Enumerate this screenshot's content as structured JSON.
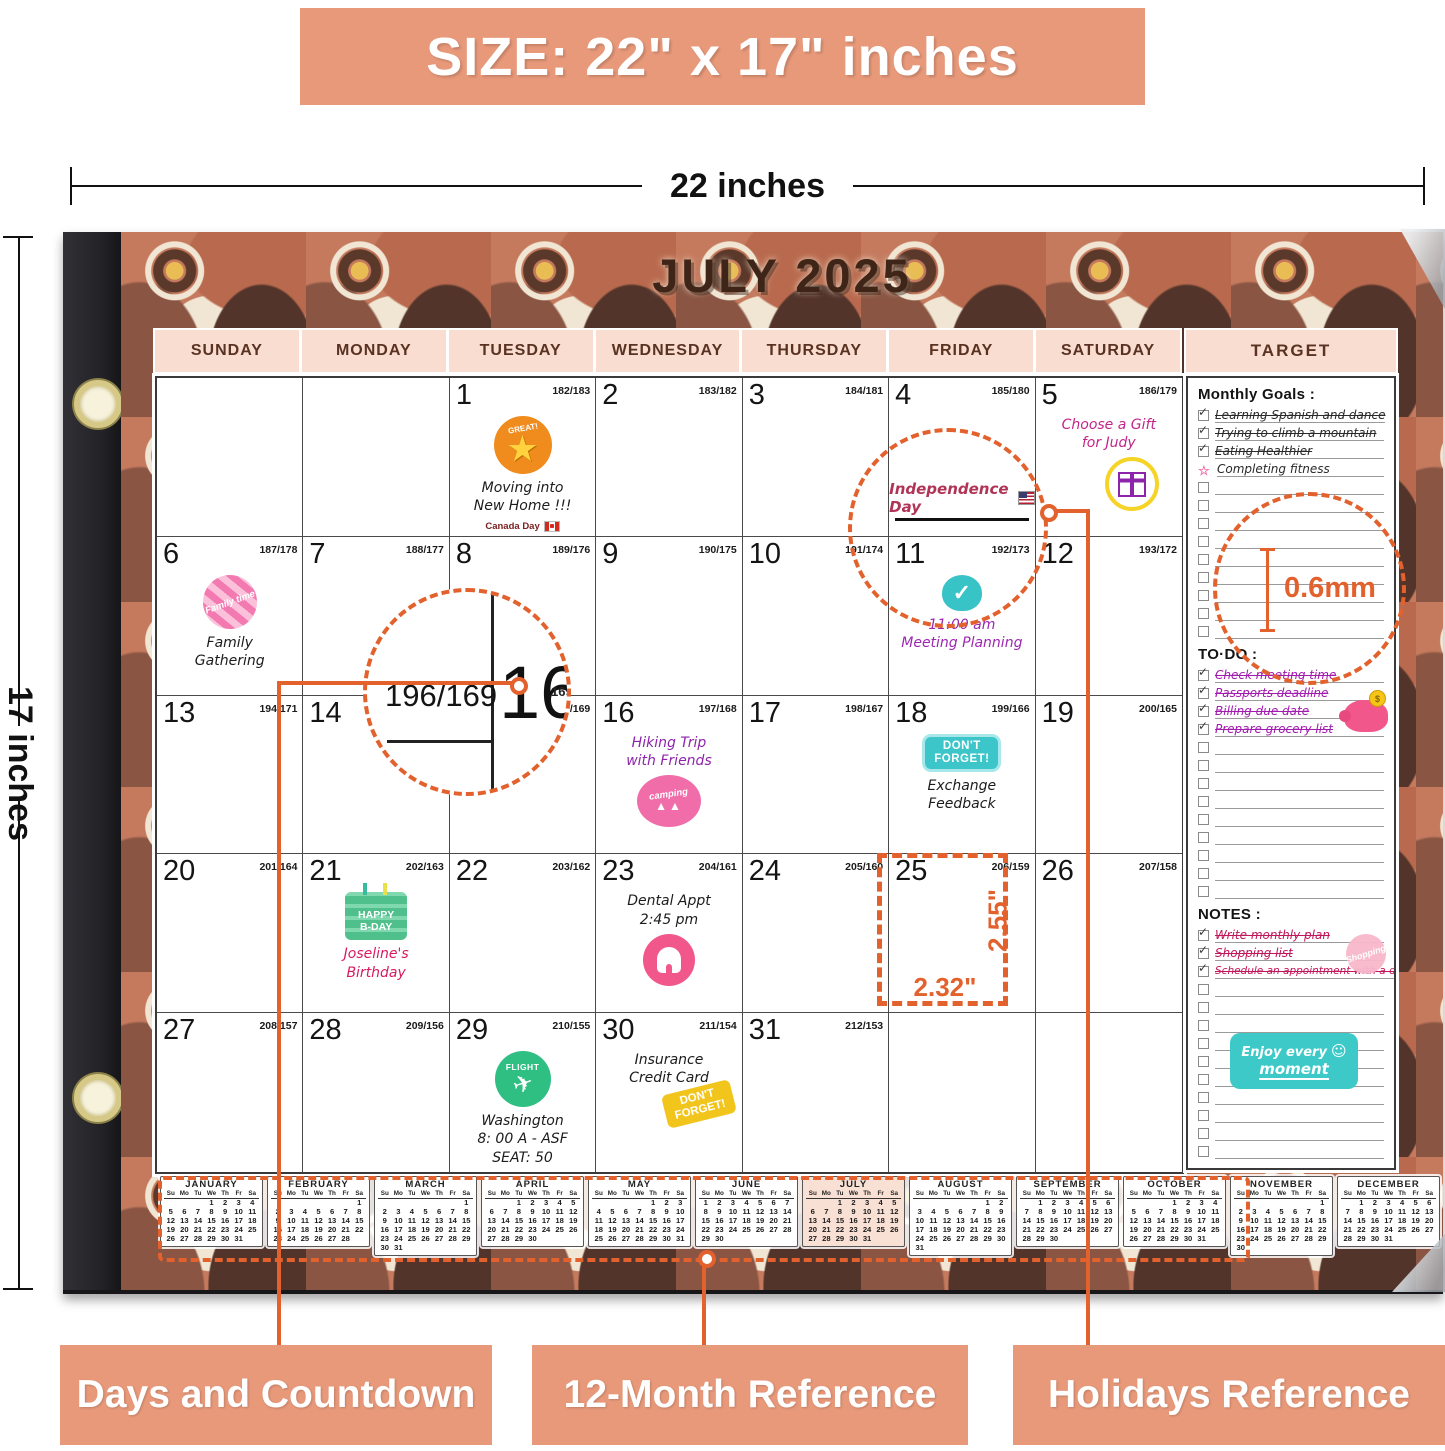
{
  "banner": {
    "text": "SIZE: 22\" x 17\" inches"
  },
  "measure": {
    "width": "22 inches",
    "height": "17 inches"
  },
  "calendar": {
    "title": "JULY 2025",
    "day_headers": [
      "SUNDAY",
      "MONDAY",
      "TUESDAY",
      "WEDNESDAY",
      "THURSDAY",
      "FRIDAY",
      "SATURDAY"
    ],
    "weeks": [
      [
        {
          "date": "",
          "countdown": ""
        },
        {
          "date": "",
          "countdown": ""
        },
        {
          "date": "1",
          "countdown": "182/183",
          "sticker": "great-star",
          "sticker_pos": "above",
          "events": [
            {
              "lines": [
                "Moving into",
                "New Home !!!"
              ],
              "color": "#1c1c1c"
            }
          ],
          "footer": "Canada Day"
        },
        {
          "date": "2",
          "countdown": "183/182"
        },
        {
          "date": "3",
          "countdown": "184/181"
        },
        {
          "date": "4",
          "countdown": "185/180",
          "holiday": "Independence Day"
        },
        {
          "date": "5",
          "countdown": "186/179",
          "sticker": "gift",
          "sticker_pos": "below",
          "events": [
            {
              "lines": [
                "Choose a Gift",
                "for Judy"
              ],
              "color": "#c2258a"
            }
          ]
        }
      ],
      [
        {
          "date": "6",
          "countdown": "187/178",
          "sticker": "family-time",
          "sticker_pos": "above",
          "events": [
            {
              "lines": [
                "Family",
                "Gathering"
              ],
              "color": "#1c1c1c"
            }
          ]
        },
        {
          "date": "7",
          "countdown": "188/177"
        },
        {
          "date": "8",
          "countdown": "189/176"
        },
        {
          "date": "9",
          "countdown": "190/175"
        },
        {
          "date": "10",
          "countdown": "191/174"
        },
        {
          "date": "11",
          "countdown": "192/173",
          "sticker": "check",
          "sticker_pos": "above",
          "events": [
            {
              "lines": [
                "11:00 am",
                "Meeting Planning"
              ],
              "color": "#9c27b0"
            }
          ]
        },
        {
          "date": "12",
          "countdown": "193/172"
        }
      ],
      [
        {
          "date": "13",
          "countdown": "194/171"
        },
        {
          "date": "14",
          "countdown": "195/170"
        },
        {
          "date": "15",
          "countdown": "196/169"
        },
        {
          "date": "16",
          "countdown": "197/168",
          "sticker": "camping",
          "sticker_pos": "below",
          "events": [
            {
              "lines": [
                "Hiking Trip",
                "with Friends"
              ],
              "color": "#8e24aa"
            }
          ]
        },
        {
          "date": "17",
          "countdown": "198/167"
        },
        {
          "date": "18",
          "countdown": "199/166",
          "sticker": "dont-forget-teal",
          "sticker_pos": "above",
          "events": [
            {
              "lines": [
                "Exchange",
                "Feedback"
              ],
              "color": "#1c1c1c"
            }
          ]
        },
        {
          "date": "19",
          "countdown": "200/165"
        }
      ],
      [
        {
          "date": "20",
          "countdown": "201/164"
        },
        {
          "date": "21",
          "countdown": "202/163",
          "sticker": "birthday-cake",
          "sticker_pos": "above",
          "events": [
            {
              "lines": [
                "Joseline's",
                "Birthday"
              ],
              "color": "#d81b60"
            }
          ]
        },
        {
          "date": "22",
          "countdown": "203/162"
        },
        {
          "date": "23",
          "countdown": "204/161",
          "sticker": "tooth",
          "sticker_pos": "below",
          "events": [
            {
              "lines": [
                "Dental Appt",
                "2:45 pm"
              ],
              "color": "#1c1c1c"
            }
          ]
        },
        {
          "date": "24",
          "countdown": "205/160"
        },
        {
          "date": "25",
          "countdown": "206/159"
        },
        {
          "date": "26",
          "countdown": "207/158"
        }
      ],
      [
        {
          "date": "27",
          "countdown": "208/157"
        },
        {
          "date": "28",
          "countdown": "209/156"
        },
        {
          "date": "29",
          "countdown": "210/155",
          "sticker": "flight",
          "sticker_pos": "above",
          "events": [
            {
              "lines": [
                "Washington",
                "8: 00 A - ASF",
                "SEAT: 50"
              ],
              "color": "#1c1c1c"
            }
          ]
        },
        {
          "date": "30",
          "countdown": "211/154",
          "sticker": "dont-forget-yellow",
          "sticker_pos": "below",
          "events": [
            {
              "lines": [
                "Insurance",
                "Credit Card"
              ],
              "color": "#1c1c1c"
            }
          ]
        },
        {
          "date": "31",
          "countdown": "212/153"
        },
        {
          "date": "",
          "countdown": ""
        },
        {
          "date": "",
          "countdown": ""
        }
      ]
    ]
  },
  "sticker_labels": {
    "great-star": "GREAT!",
    "family-time": "Family time",
    "check": "✓",
    "camping": "camping",
    "dont-forget-line1": "DON'T",
    "dont-forget-line2": "FORGET!",
    "birthday-line1": "HAPPY",
    "birthday-line2": "B-DAY",
    "flight": "FLIGHT",
    "shopping": "Shopping",
    "piggy_coin": "$",
    "enjoy_line1": "Enjoy every",
    "enjoy_line2": "moment",
    "smiley": "☺"
  },
  "sidebar": {
    "header": "TARGET",
    "monthly_goals": {
      "title": "Monthly Goals :",
      "color": "#2a2a2a",
      "empty_rows": 9,
      "items": [
        {
          "text": "Learning Spanish and dance",
          "marker": "check",
          "struck": true
        },
        {
          "text": "Trying to climb a mountain",
          "marker": "check",
          "struck": true
        },
        {
          "text": "Eating Healthier",
          "marker": "check",
          "struck": true
        },
        {
          "text": "Completing fitness",
          "marker": "star",
          "struck": false
        }
      ]
    },
    "todo": {
      "title": "TO·DO :",
      "color": "#a21caf",
      "empty_rows": 9,
      "items": [
        {
          "text": "Check meeting time",
          "marker": "check",
          "struck": true
        },
        {
          "text": "Passports deadline",
          "marker": "check",
          "struck": true
        },
        {
          "text": "Billing due date",
          "marker": "check",
          "struck": true
        },
        {
          "text": "Prepare grocery list",
          "marker": "check",
          "struck": true
        }
      ]
    },
    "notes": {
      "title": "NOTES :",
      "color": "#c2185b",
      "empty_rows": 10,
      "items": [
        {
          "text": "Write monthly plan",
          "marker": "check",
          "struck": true
        },
        {
          "text": "Shopping list",
          "marker": "check",
          "struck": true
        },
        {
          "text": "Schedule an appointment with a dentist",
          "marker": "check",
          "struck": true
        }
      ]
    }
  },
  "annotations": {
    "magnified_countdown": "196/169",
    "magnified_date": "16",
    "magnified_fragment": "169",
    "cell_height": "2.55\"",
    "cell_width": "2.32\"",
    "paper_thickness": "0.6mm"
  },
  "mini_day_headers": [
    "Su",
    "Mo",
    "Tu",
    "We",
    "Th",
    "Fr",
    "Sa"
  ],
  "mini_calendars": [
    {
      "month": "JANUARY",
      "highlight": false,
      "rows": [
        [
          "",
          "",
          "",
          1,
          2,
          3,
          4
        ],
        [
          5,
          6,
          7,
          8,
          9,
          10,
          11
        ],
        [
          12,
          13,
          14,
          15,
          16,
          17,
          18
        ],
        [
          19,
          20,
          21,
          22,
          23,
          24,
          25
        ],
        [
          26,
          27,
          28,
          29,
          30,
          31,
          ""
        ]
      ]
    },
    {
      "month": "FEBRUARY",
      "highlight": false,
      "rows": [
        [
          "",
          "",
          "",
          "",
          "",
          "",
          1
        ],
        [
          2,
          3,
          4,
          5,
          6,
          7,
          8
        ],
        [
          9,
          10,
          11,
          12,
          13,
          14,
          15
        ],
        [
          16,
          17,
          18,
          19,
          20,
          21,
          22
        ],
        [
          23,
          24,
          25,
          26,
          27,
          28,
          ""
        ]
      ]
    },
    {
      "month": "MARCH",
      "highlight": false,
      "rows": [
        [
          "",
          "",
          "",
          "",
          "",
          "",
          1
        ],
        [
          2,
          3,
          4,
          5,
          6,
          7,
          8
        ],
        [
          9,
          10,
          11,
          12,
          13,
          14,
          15
        ],
        [
          16,
          17,
          18,
          19,
          20,
          21,
          22
        ],
        [
          23,
          24,
          25,
          26,
          27,
          28,
          29
        ],
        [
          30,
          31,
          "",
          "",
          "",
          "",
          ""
        ]
      ]
    },
    {
      "month": "APRIL",
      "highlight": false,
      "rows": [
        [
          "",
          "",
          1,
          2,
          3,
          4,
          5
        ],
        [
          6,
          7,
          8,
          9,
          10,
          11,
          12
        ],
        [
          13,
          14,
          15,
          16,
          17,
          18,
          19
        ],
        [
          20,
          21,
          22,
          23,
          24,
          25,
          26
        ],
        [
          27,
          28,
          29,
          30,
          "",
          "",
          ""
        ]
      ]
    },
    {
      "month": "MAY",
      "highlight": false,
      "rows": [
        [
          "",
          "",
          "",
          "",
          1,
          2,
          3
        ],
        [
          4,
          5,
          6,
          7,
          8,
          9,
          10
        ],
        [
          11,
          12,
          13,
          14,
          15,
          16,
          17
        ],
        [
          18,
          19,
          20,
          21,
          22,
          23,
          24
        ],
        [
          25,
          26,
          27,
          28,
          29,
          30,
          31
        ]
      ]
    },
    {
      "month": "JUNE",
      "highlight": false,
      "rows": [
        [
          1,
          2,
          3,
          4,
          5,
          6,
          7
        ],
        [
          8,
          9,
          10,
          11,
          12,
          13,
          14
        ],
        [
          15,
          16,
          17,
          18,
          19,
          20,
          21
        ],
        [
          22,
          23,
          24,
          25,
          26,
          27,
          28
        ],
        [
          29,
          30,
          "",
          "",
          "",
          "",
          ""
        ]
      ]
    },
    {
      "month": "JULY",
      "highlight": true,
      "rows": [
        [
          "",
          "",
          1,
          2,
          3,
          4,
          5
        ],
        [
          6,
          7,
          8,
          9,
          10,
          11,
          12
        ],
        [
          13,
          14,
          15,
          16,
          17,
          18,
          19
        ],
        [
          20,
          21,
          22,
          23,
          24,
          25,
          26
        ],
        [
          27,
          28,
          29,
          30,
          31,
          "",
          ""
        ]
      ]
    },
    {
      "month": "AUGUST",
      "highlight": false,
      "rows": [
        [
          "",
          "",
          "",
          "",
          "",
          1,
          2
        ],
        [
          3,
          4,
          5,
          6,
          7,
          8,
          9
        ],
        [
          10,
          11,
          12,
          13,
          14,
          15,
          16
        ],
        [
          17,
          18,
          19,
          20,
          21,
          22,
          23
        ],
        [
          24,
          25,
          26,
          27,
          28,
          29,
          30
        ],
        [
          31,
          "",
          "",
          "",
          "",
          "",
          ""
        ]
      ]
    },
    {
      "month": "SEPTEMBER",
      "highlight": false,
      "rows": [
        [
          "",
          1,
          2,
          3,
          4,
          5,
          6
        ],
        [
          7,
          8,
          9,
          10,
          11,
          12,
          13
        ],
        [
          14,
          15,
          16,
          17,
          18,
          19,
          20
        ],
        [
          21,
          22,
          23,
          24,
          25,
          26,
          27
        ],
        [
          28,
          29,
          30,
          "",
          "",
          "",
          ""
        ]
      ]
    },
    {
      "month": "OCTOBER",
      "highlight": false,
      "rows": [
        [
          "",
          "",
          "",
          1,
          2,
          3,
          4
        ],
        [
          5,
          6,
          7,
          8,
          9,
          10,
          11
        ],
        [
          12,
          13,
          14,
          15,
          16,
          17,
          18
        ],
        [
          19,
          20,
          21,
          22,
          23,
          24,
          25
        ],
        [
          26,
          27,
          28,
          29,
          30,
          31,
          ""
        ]
      ]
    },
    {
      "month": "NOVEMBER",
      "highlight": false,
      "rows": [
        [
          "",
          "",
          "",
          "",
          "",
          "",
          1
        ],
        [
          2,
          3,
          4,
          5,
          6,
          7,
          8
        ],
        [
          9,
          10,
          11,
          12,
          13,
          14,
          15
        ],
        [
          16,
          17,
          18,
          19,
          20,
          21,
          22
        ],
        [
          23,
          24,
          25,
          26,
          27,
          28,
          29
        ],
        [
          30,
          "",
          "",
          "",
          "",
          "",
          ""
        ]
      ]
    },
    {
      "month": "DECEMBER",
      "highlight": false,
      "rows": [
        [
          "",
          1,
          2,
          3,
          4,
          5,
          6
        ],
        [
          7,
          8,
          9,
          10,
          11,
          12,
          13
        ],
        [
          14,
          15,
          16,
          17,
          18,
          19,
          20
        ],
        [
          21,
          22,
          23,
          24,
          25,
          26,
          27
        ],
        [
          28,
          29,
          30,
          31,
          "",
          "",
          ""
        ]
      ]
    }
  ],
  "bottom_labels": [
    "Days and Countdown",
    "12-Month Reference",
    "Holidays Reference"
  ]
}
